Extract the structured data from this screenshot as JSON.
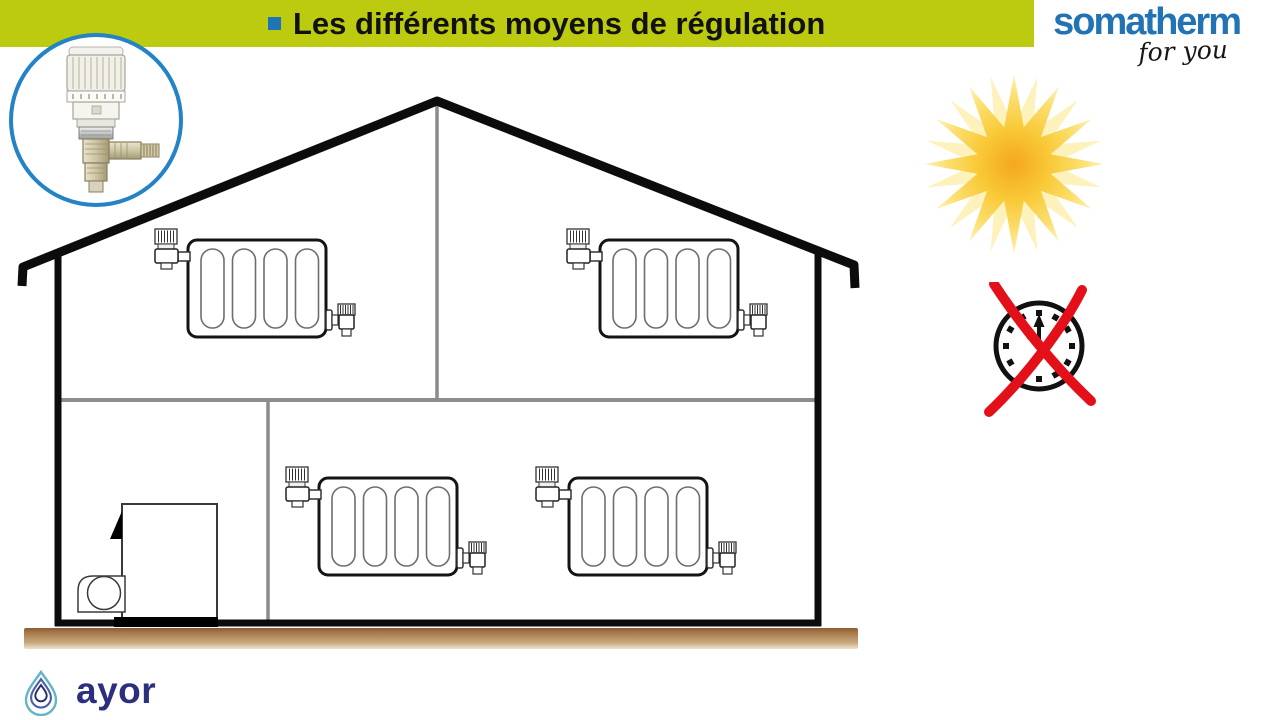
{
  "header": {
    "title": "Les différents moyens de régulation",
    "bullet_color": "#1e74b8",
    "bg_color": "#bccb0f"
  },
  "brand": {
    "name": "somatherm",
    "tagline": "for you",
    "name_color": "#2173b3"
  },
  "badge": {
    "icon": "thermostatic-radiator-valve-photo"
  },
  "diagram": {
    "type": "house-heating-cross-section",
    "floors": 2,
    "radiator_count": 4,
    "has_boiler": true,
    "icons": [
      "sun-icon",
      "no-timer-clock-icon"
    ],
    "ground_color": "#aa7b4e",
    "wall_color": "#0c0c0c",
    "partition_color": "#8c8c8c"
  },
  "footer": {
    "brand": "ayor",
    "color": "#2b2f7e",
    "icon": "water-drop-icon"
  }
}
